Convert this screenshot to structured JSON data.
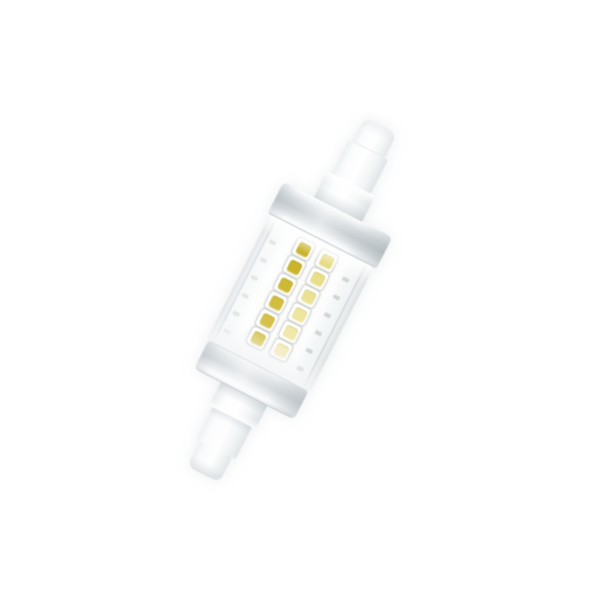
{
  "scene": {
    "description": "Product photo of a linear R7s LED lamp (78 mm slim type) on a plain white background, tilted clockwise about 27 degrees. Clear glass tube reveals a white LED board with two columns of six SMD LED chips: left column deep gold-yellow, right column pale cream-yellow. Aluminum collar rings at both tube ends, white ceramic end caps with recessed contact tips.",
    "background_color": "#ffffff",
    "rotation_deg": 27,
    "center_x": 294,
    "center_y": 296,
    "lamp_box_width": 122,
    "lamp_box_height": 384
  },
  "lamp": {
    "segments": [
      {
        "name": "top-cap-tip",
        "css": "cap-tip-top",
        "width": 36,
        "height": 26
      },
      {
        "name": "top-cap-body",
        "css": "cap-body-top",
        "width": 44,
        "height": 38
      },
      {
        "name": "top-neck",
        "css": "neck-top",
        "width": 54,
        "height": 28
      },
      {
        "name": "top-metal-collar",
        "css": "collar-top",
        "width": 122,
        "height": 34
      },
      {
        "name": "glass-tube",
        "css": "tube",
        "width": 116,
        "height": 140
      },
      {
        "name": "bottom-metal-collar",
        "css": "collar-bottom",
        "width": 112,
        "height": 30
      },
      {
        "name": "bottom-neck",
        "css": "neck-bottom",
        "width": 52,
        "height": 26
      },
      {
        "name": "bottom-cap-body",
        "css": "cap-body-bottom",
        "width": 44,
        "height": 36
      },
      {
        "name": "bottom-cap-tip",
        "css": "cap-tip-bottom",
        "width": 36,
        "height": 26
      }
    ]
  },
  "led_board": {
    "board_width": 58,
    "rows": 6,
    "cols": 2,
    "first_row_center_y": 16,
    "row_pitch": 20,
    "col_center_offsets": [
      -13,
      13
    ],
    "chip_outer_size": 18,
    "chip_inner_size": 13
  },
  "chips": [
    {
      "row": 0,
      "col": 0,
      "color": "#c7b227"
    },
    {
      "row": 1,
      "col": 0,
      "color": "#c9b42c"
    },
    {
      "row": 2,
      "col": 0,
      "color": "#cdb936"
    },
    {
      "row": 3,
      "col": 0,
      "color": "#d1bd40"
    },
    {
      "row": 4,
      "col": 0,
      "color": "#d4c24c"
    },
    {
      "row": 5,
      "col": 0,
      "color": "#d8c85a"
    },
    {
      "row": 0,
      "col": 1,
      "color": "#e7db82"
    },
    {
      "row": 1,
      "col": 1,
      "color": "#e9de8a"
    },
    {
      "row": 2,
      "col": 1,
      "color": "#ebe194"
    },
    {
      "row": 3,
      "col": 1,
      "color": "#eee59e"
    },
    {
      "row": 4,
      "col": 1,
      "color": "#f0e8aa"
    },
    {
      "row": 5,
      "col": 1,
      "color": "#f3ecb8"
    }
  ],
  "solder_pads": {
    "count_per_side": 6,
    "start_y": 22,
    "pitch": 20,
    "right_offset_from_center": 38,
    "left_offset_from_center": -44,
    "color": "#c6cac6",
    "right_opacity": 0.75,
    "left_opacity": 0.4
  },
  "palette": {
    "ceramic_white": "#fbfcfd",
    "metal_mid_gray": "#c7cdd1",
    "glass_edge_gray": "#dde2e4",
    "led_gold": "#c9b42c",
    "led_cream": "#eee59e"
  }
}
